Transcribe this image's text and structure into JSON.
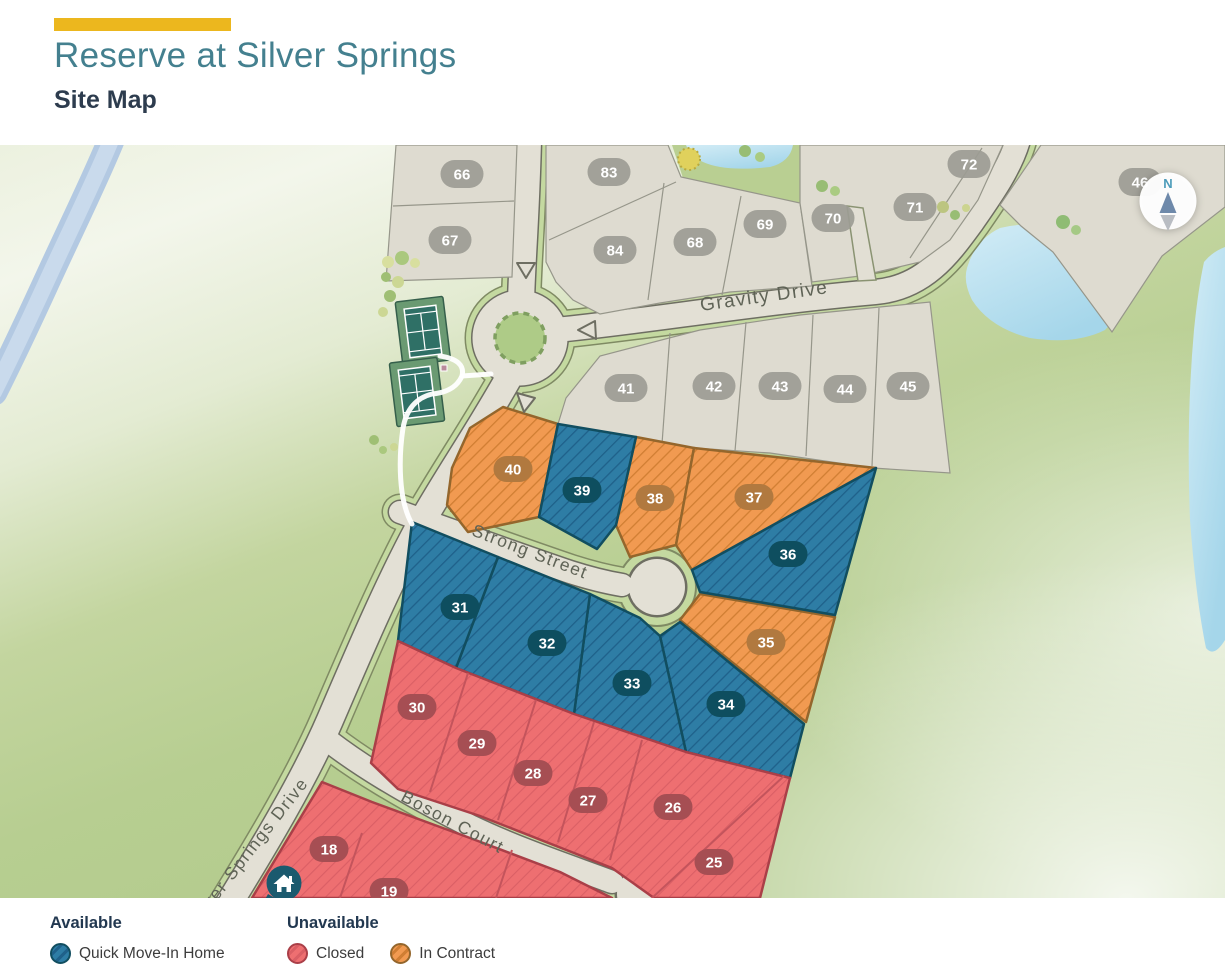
{
  "header": {
    "title": "Reserve at Silver Springs",
    "subtitle": "Site Map"
  },
  "compass": {
    "label": "N"
  },
  "streets": [
    {
      "name": "Gravity Drive",
      "x": 765,
      "y": 302,
      "rotate": -8,
      "size": 19,
      "anchor": "middle"
    },
    {
      "name": "Strong Street",
      "x": 528,
      "y": 557,
      "rotate": 21,
      "size": 17.5,
      "anchor": "middle"
    },
    {
      "name": "Boson Court",
      "x": 450,
      "y": 827,
      "rotate": 28,
      "size": 17.5,
      "anchor": "middle"
    },
    {
      "name": "Silver Springs Drive",
      "x": 196,
      "y": 928,
      "rotate": -52,
      "size": 17.5,
      "anchor": "start"
    }
  ],
  "lots": [
    {
      "number": "66",
      "status": "standard",
      "x": 462,
      "y": 174
    },
    {
      "number": "67",
      "status": "standard",
      "x": 450,
      "y": 240
    },
    {
      "number": "83",
      "status": "standard",
      "x": 609,
      "y": 172
    },
    {
      "number": "84",
      "status": "standard",
      "x": 615,
      "y": 250
    },
    {
      "number": "68",
      "status": "standard",
      "x": 695,
      "y": 242
    },
    {
      "number": "69",
      "status": "standard",
      "x": 765,
      "y": 224
    },
    {
      "number": "70",
      "status": "standard",
      "x": 833,
      "y": 218
    },
    {
      "number": "71",
      "status": "standard",
      "x": 915,
      "y": 207
    },
    {
      "number": "72",
      "status": "standard",
      "x": 969,
      "y": 164
    },
    {
      "number": "46",
      "status": "standard",
      "x": 1140,
      "y": 182
    },
    {
      "number": "41",
      "status": "standard",
      "x": 626,
      "y": 388
    },
    {
      "number": "42",
      "status": "standard",
      "x": 714,
      "y": 386
    },
    {
      "number": "43",
      "status": "standard",
      "x": 780,
      "y": 386
    },
    {
      "number": "44",
      "status": "standard",
      "x": 845,
      "y": 389
    },
    {
      "number": "45",
      "status": "standard",
      "x": 908,
      "y": 386
    },
    {
      "number": "40",
      "status": "contract",
      "x": 513,
      "y": 469
    },
    {
      "number": "39",
      "status": "quick",
      "x": 582,
      "y": 490
    },
    {
      "number": "38",
      "status": "contract",
      "x": 655,
      "y": 498
    },
    {
      "number": "37",
      "status": "contract",
      "x": 754,
      "y": 497
    },
    {
      "number": "36",
      "status": "quick",
      "x": 788,
      "y": 554
    },
    {
      "number": "35",
      "status": "contract",
      "x": 766,
      "y": 642
    },
    {
      "number": "34",
      "status": "quick",
      "x": 726,
      "y": 704
    },
    {
      "number": "33",
      "status": "quick",
      "x": 632,
      "y": 683
    },
    {
      "number": "32",
      "status": "quick",
      "x": 547,
      "y": 643
    },
    {
      "number": "31",
      "status": "quick",
      "x": 460,
      "y": 607
    },
    {
      "number": "30",
      "status": "closed",
      "x": 417,
      "y": 707
    },
    {
      "number": "29",
      "status": "closed",
      "x": 477,
      "y": 743
    },
    {
      "number": "28",
      "status": "closed",
      "x": 533,
      "y": 773
    },
    {
      "number": "27",
      "status": "closed",
      "x": 588,
      "y": 800
    },
    {
      "number": "26",
      "status": "closed",
      "x": 673,
      "y": 807
    },
    {
      "number": "25",
      "status": "closed",
      "x": 714,
      "y": 862
    },
    {
      "number": "18",
      "status": "closed",
      "x": 329,
      "y": 849
    },
    {
      "number": "19",
      "status": "closed",
      "x": 389,
      "y": 891
    }
  ],
  "legend": {
    "available_heading": "Available",
    "unavailable_heading": "Unavailable",
    "items": [
      {
        "label": "Quick Move-In Home",
        "status": "quick",
        "color": "#2e7da5"
      },
      {
        "label": "Closed",
        "status": "closed",
        "color": "#ee6f71"
      },
      {
        "label": "In Contract",
        "status": "contract",
        "color": "#f19a51"
      }
    ]
  },
  "colors": {
    "accent_yellow": "#ecb71e",
    "title_teal": "#44808f",
    "heading_navy": "#2d3c4e",
    "quick": "#2e7da5",
    "closed": "#ee6f71",
    "contract": "#f19a51",
    "standard_lot": "#dedbd0"
  }
}
